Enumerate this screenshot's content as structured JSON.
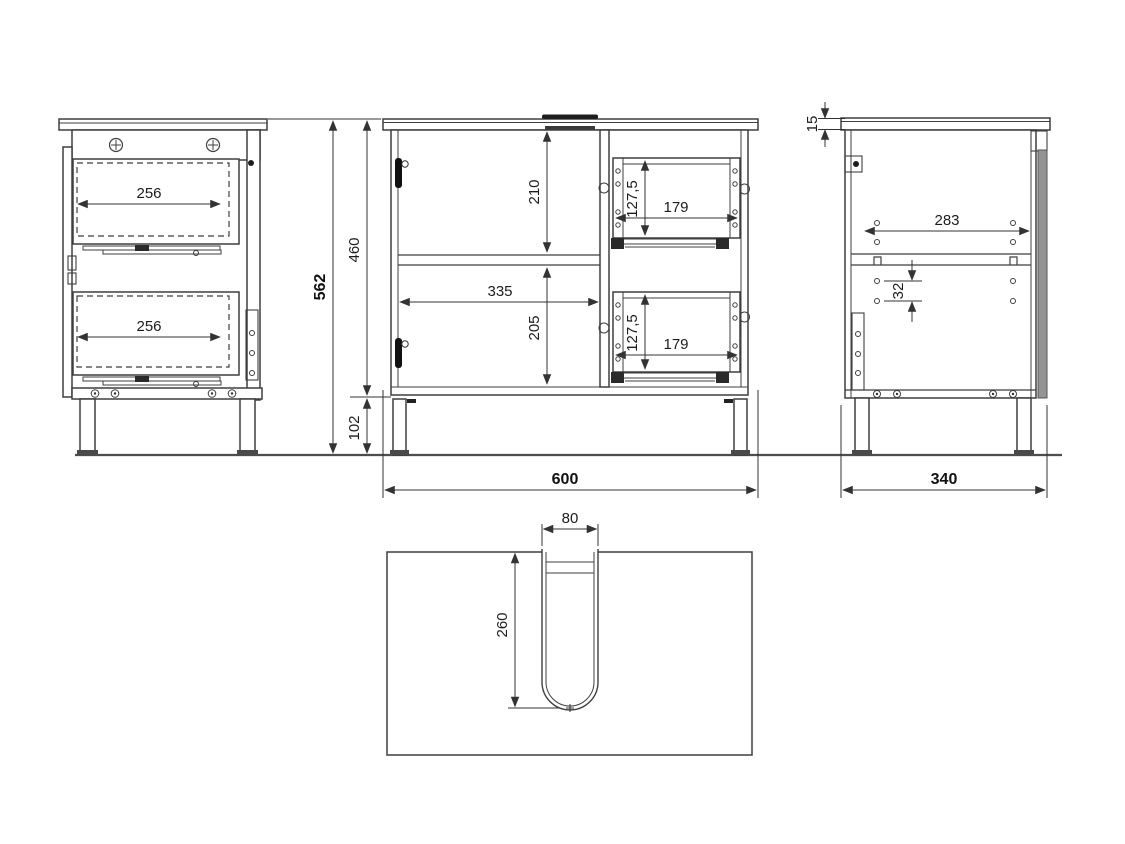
{
  "document": {
    "type": "technical-drawing",
    "subject": "vanity cabinet with two drawers, door compartment and sink plumbing cutout",
    "units": "mm"
  },
  "colors": {
    "background": "#ffffff",
    "line": "#3f3f3f",
    "text": "#1c1c1c",
    "fill_dark": "#1e1e1e",
    "fill_gray": "#949494"
  },
  "views": {
    "left_side": {
      "label": "left side view",
      "dimensions": {
        "drawer_depth_upper": "256",
        "drawer_depth_lower": "256"
      }
    },
    "front": {
      "label": "front view",
      "dimensions": {
        "overall_height": "562",
        "carcass_height": "460",
        "leg_height": "102",
        "upper_opening_height": "210",
        "lower_opening_height": "205",
        "opening_width": "335",
        "upper_drawer_height": "127,5",
        "upper_drawer_width": "179",
        "lower_drawer_height": "127,5",
        "lower_drawer_width": "179",
        "overall_width": "600"
      }
    },
    "right_side": {
      "label": "right side view",
      "dimensions": {
        "worktop_thickness": "15",
        "hole_span_depth": "283",
        "hole_pitch": "32",
        "overall_depth": "340"
      }
    },
    "top": {
      "label": "top view",
      "dimensions": {
        "cutout_width": "80",
        "cutout_depth": "260"
      }
    }
  }
}
